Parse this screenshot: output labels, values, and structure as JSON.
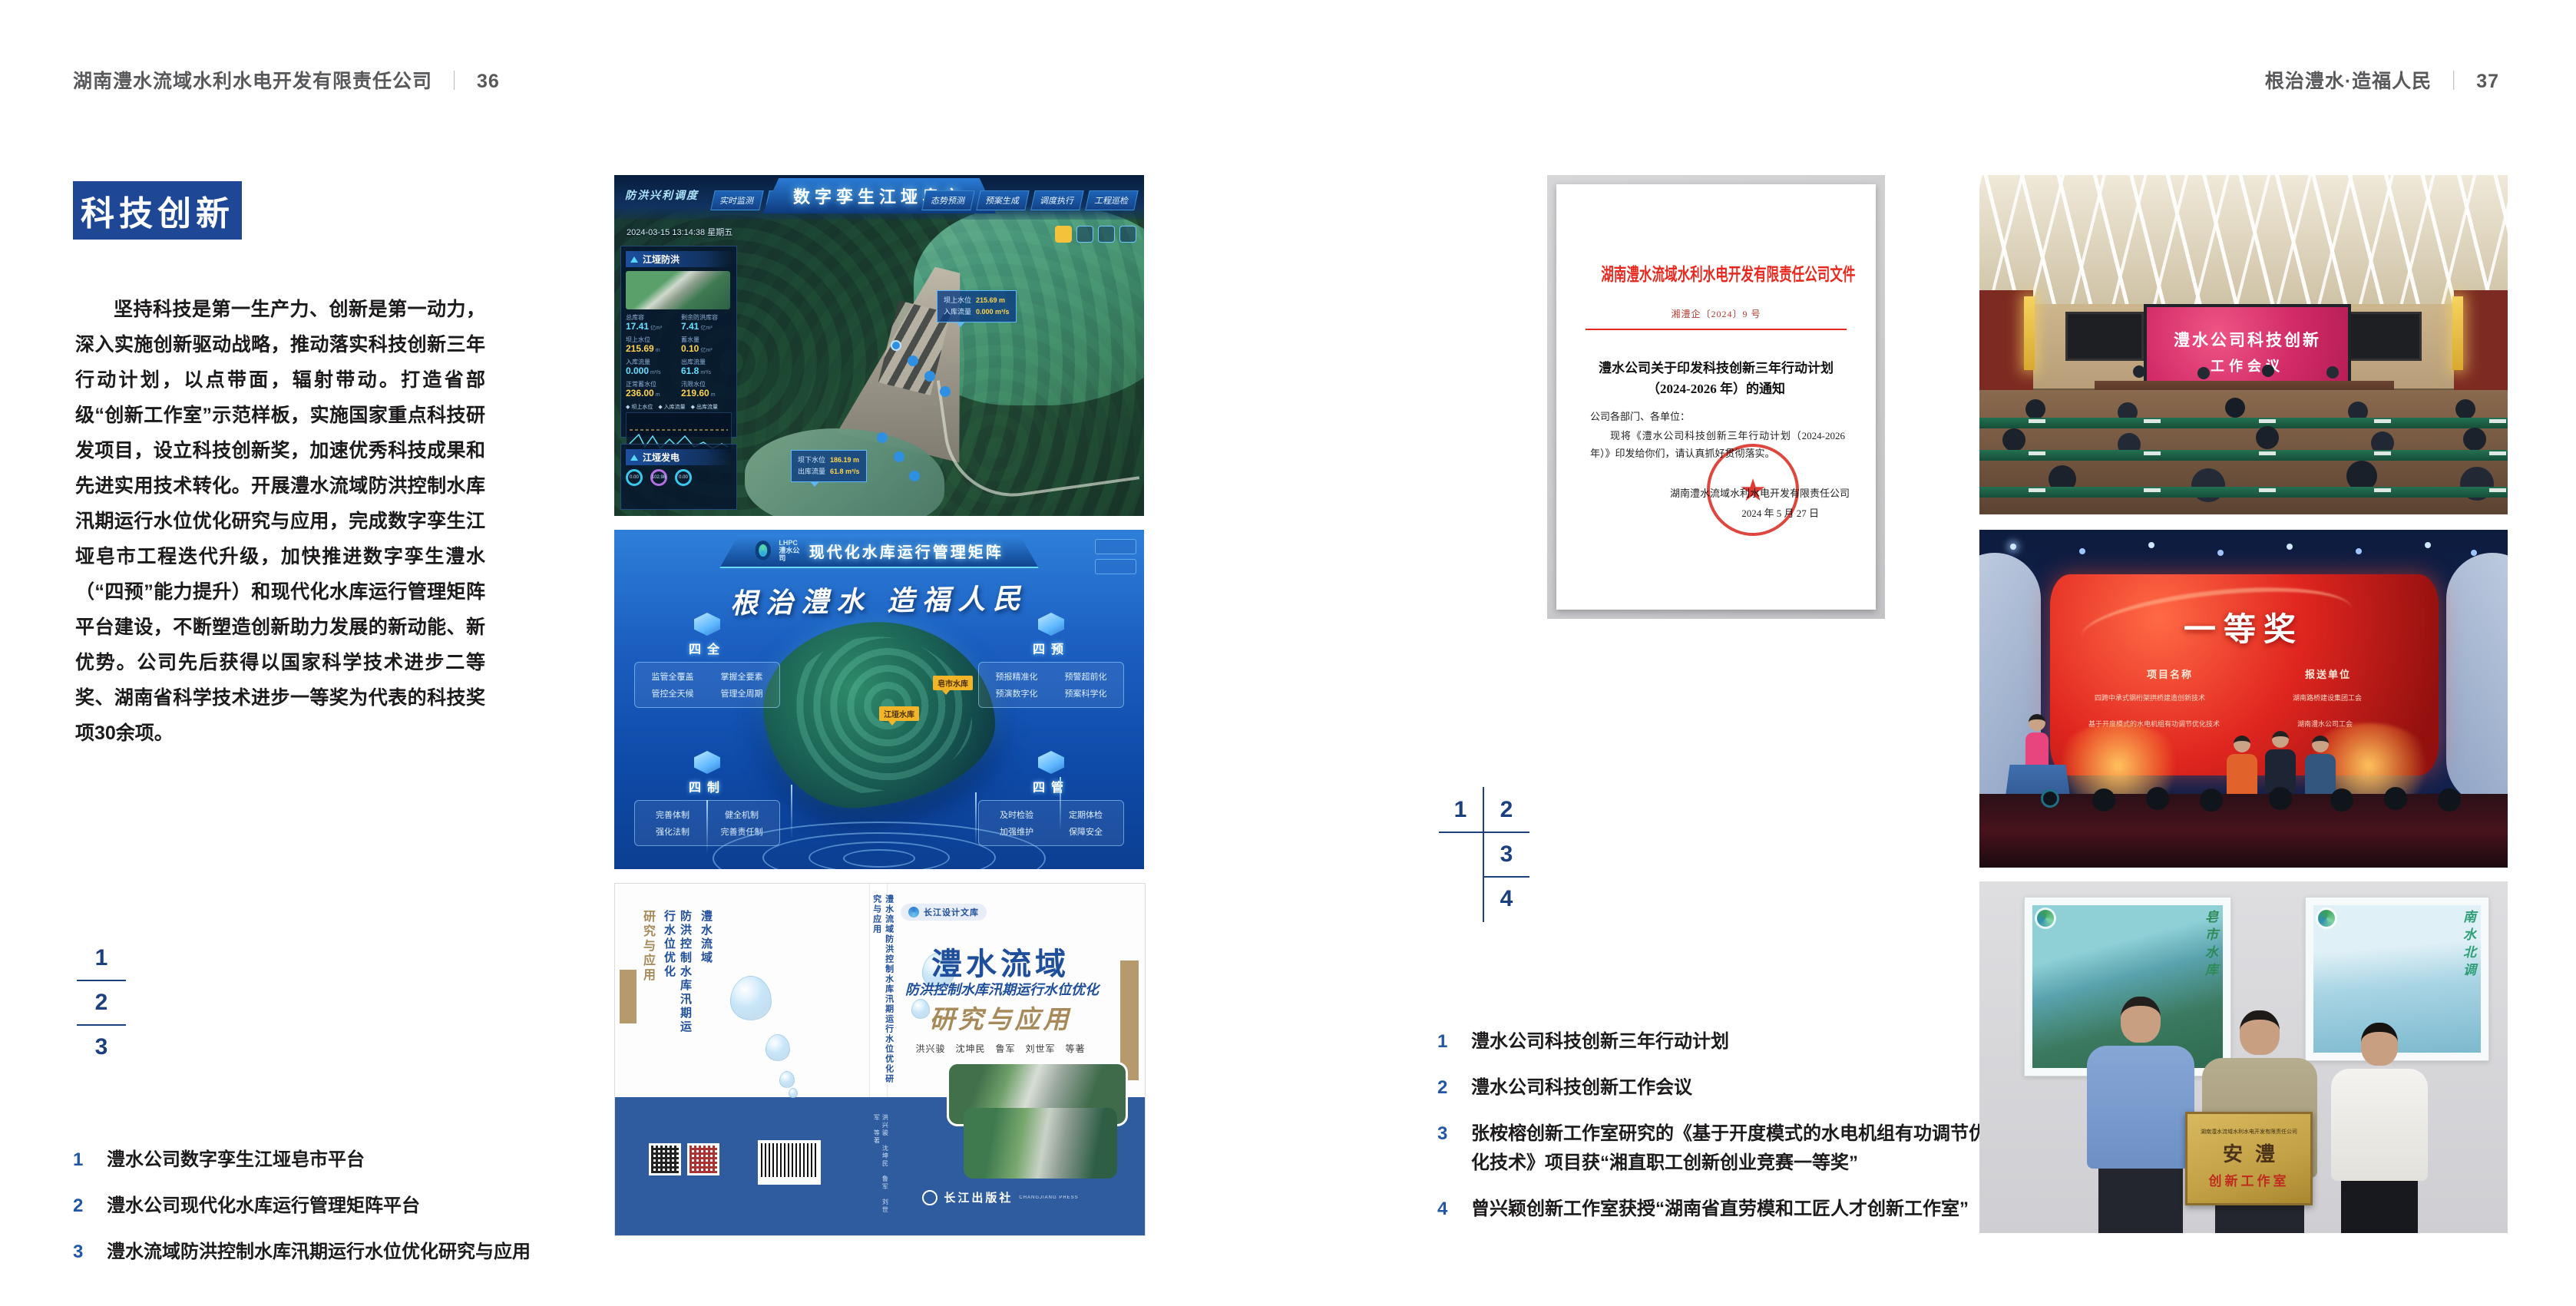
{
  "left_page": {
    "header": {
      "company": "湖南澧水流域水利水电开发有限责任公司",
      "divider": "｜",
      "page_number": "36"
    },
    "section_title": "科技创新",
    "body_paragraph": "坚持科技是第一生产力、创新是第一动力，深入实施创新驱动战略，推动落实科技创新三年行动计划，以点带面，辐射带动。打造省部级“创新工作室”示范样板，实施国家重点科技研发项目，设立科技创新奖，加速优秀科技成果和先进实用技术转化。开展澧水流域防洪控制水库汛期运行水位优化研究与应用，完成数字孪生江垭皂市工程迭代升级，加快推进数字孪生澧水（“四预”能力提升）和现代化水库运行管理矩阵平台建设，不断塑造创新助力发展的新动能、新优势。公司先后获得以国家科学技术进步二等奖、湖南省科学技术进步一等奖为代表的科技奖项30余项。",
    "figure_index": {
      "n1": "1",
      "n2": "2",
      "n3": "3"
    },
    "captions": [
      {
        "num": "1",
        "text": "澧水公司数字孪生江垭皂市平台"
      },
      {
        "num": "2",
        "text": "澧水公司现代化水库运行管理矩阵平台"
      },
      {
        "num": "3",
        "text": "澧水流域防洪控制水库汛期运行水位优化研究与应用"
      }
    ]
  },
  "right_page": {
    "header": {
      "slogan": "根治澧水·造福人民",
      "divider": "｜",
      "page_number": "37"
    },
    "figure_index": {
      "n1": "1",
      "n2": "2",
      "n3": "3",
      "n4": "4"
    },
    "captions": [
      {
        "num": "1",
        "text": "澧水公司科技创新三年行动计划"
      },
      {
        "num": "2",
        "text": "澧水公司科技创新工作会议"
      },
      {
        "num": "3",
        "text": "张桉榕创新工作室研究的《基于开度模式的水电机组有功调节优化技术》项目获“湘直职工创新创业竞赛一等奖”"
      },
      {
        "num": "4",
        "text": "曾兴颖创新工作室获授“湖南省直劳模和工匠人才创新工作室”"
      }
    ]
  },
  "fig_digital_twin": {
    "title": "数字孪生江垭皂市",
    "module_label": "防洪兴利调度",
    "tabs_left": [
      "实时监测",
      "洪水预报",
      "防洪预警"
    ],
    "tabs_right": [
      "态势预测",
      "预案生成",
      "调度执行",
      "工程巡检"
    ],
    "datetime": "2024-03-15 13:14:38 星期五",
    "panel_flood": {
      "title": "江垭防洪",
      "stats": [
        {
          "label": "总库容",
          "value": "17.41",
          "unit": "亿m³"
        },
        {
          "label": "剩余防洪库容",
          "value": "7.41",
          "unit": "亿m³"
        },
        {
          "label": "坝上水位",
          "value": "215.69",
          "unit": "m"
        },
        {
          "label": "蓄水量",
          "value": "0.10",
          "unit": "亿m³"
        },
        {
          "label": "入库流量",
          "value": "0.000",
          "unit": "m³/s"
        },
        {
          "label": "出库流量",
          "value": "61.8",
          "unit": "m³/s"
        },
        {
          "label": "正常蓄水位",
          "value": "236.00",
          "unit": "m"
        },
        {
          "label": "汛限水位",
          "value": "219.60",
          "unit": "m"
        }
      ],
      "legend": "◆ 坝上水位　◆ 入库流量　◆ 出库流量",
      "ticks": "03-12　03-13　03-13　03-14　03-14"
    },
    "panel_power": {
      "title": "江垭发电",
      "g1": "0.00",
      "g2": "102.98",
      "g3": "0.00"
    },
    "tooltip_up": {
      "label1": "坝上水位",
      "value1": "215.69 m",
      "label2": "入库流量",
      "value2": "0.000 m³/s"
    },
    "tooltip_down": {
      "label1": "坝下水位",
      "value1": "186.19 m",
      "label2": "出库流量",
      "value2": "61.8 m³/s"
    }
  },
  "fig_matrix": {
    "logo_line1": "LHPC",
    "logo_line2": "澧水公司",
    "title": "现代化水库运行管理矩阵",
    "slogan": "根治澧水 造福人民",
    "groups": [
      {
        "name": "四全",
        "items": [
          "监管全覆盖",
          "掌握全要素",
          "管控全天候",
          "管理全周期"
        ]
      },
      {
        "name": "四预",
        "items": [
          "预报精准化",
          "预警超前化",
          "预演数字化",
          "预案科学化"
        ]
      },
      {
        "name": "四制",
        "items": [
          "完善体制",
          "健全机制",
          "强化法制",
          "完善责任制"
        ]
      },
      {
        "name": "四管",
        "items": [
          "及时检验",
          "定期体检",
          "加强维护",
          "保障安全"
        ]
      }
    ],
    "marker_1": "江垭水库",
    "marker_2": "皂市水库"
  },
  "fig_book": {
    "series": "长江设计文库",
    "title_main": "澧水流域",
    "title_sub": "防洪控制水库汛期运行水位优化",
    "title_tail": "研究与应用",
    "authors": "洪兴骏　沈坤民　鲁军　刘世军　等著",
    "publisher": "长江出版社",
    "publisher_en": "CHANGJIANG PRESS",
    "spine_text": "澧水流域防洪控制水库汛期运行水位优化研究与应用",
    "back_col_main": "澧水流域",
    "back_col_sub": "防洪控制水库汛期运行水位优化",
    "back_col_tail": "研究与应用"
  },
  "fig_document": {
    "header": "湖南澧水流域水利水电开发有限责任公司文件",
    "doc_number": "湘澧企〔2024〕9 号",
    "title_line1": "澧水公司关于印发科技创新三年行动计划",
    "title_line2": "（2024-2026 年）的通知",
    "salutation": "公司各部门、各单位：",
    "body": "现将《澧水公司科技创新三年行动计划（2024-2026 年）》印发给你们，请认真抓好贯彻落实。",
    "signature": "湖南澧水流域水利水电开发有限责任公司",
    "date": "2024 年 5 月 27 日",
    "seal_star": "★"
  },
  "fig_meeting": {
    "screen_line1": "澧水公司科技创新",
    "screen_line2": "工作会议"
  },
  "fig_award": {
    "title": "一等奖",
    "col_left": "项目名称",
    "col_right": "报送单位",
    "row1_project": "四跨中承式钢桁架拱桥建造创新技术",
    "row1_org": "湖南路桥建设集团工会",
    "row2_project": "基于开度模式的水电机组有功调节优化技术",
    "row2_org": "湖南澧水公司工会"
  },
  "fig_group": {
    "plaque_header": "湖南澧水流域水利水电开发有限责任公司",
    "plaque_title": "安澧",
    "plaque_sub": "创新工作室",
    "poster_left_text": "皂市水库",
    "poster_right_text": "南水北调"
  }
}
